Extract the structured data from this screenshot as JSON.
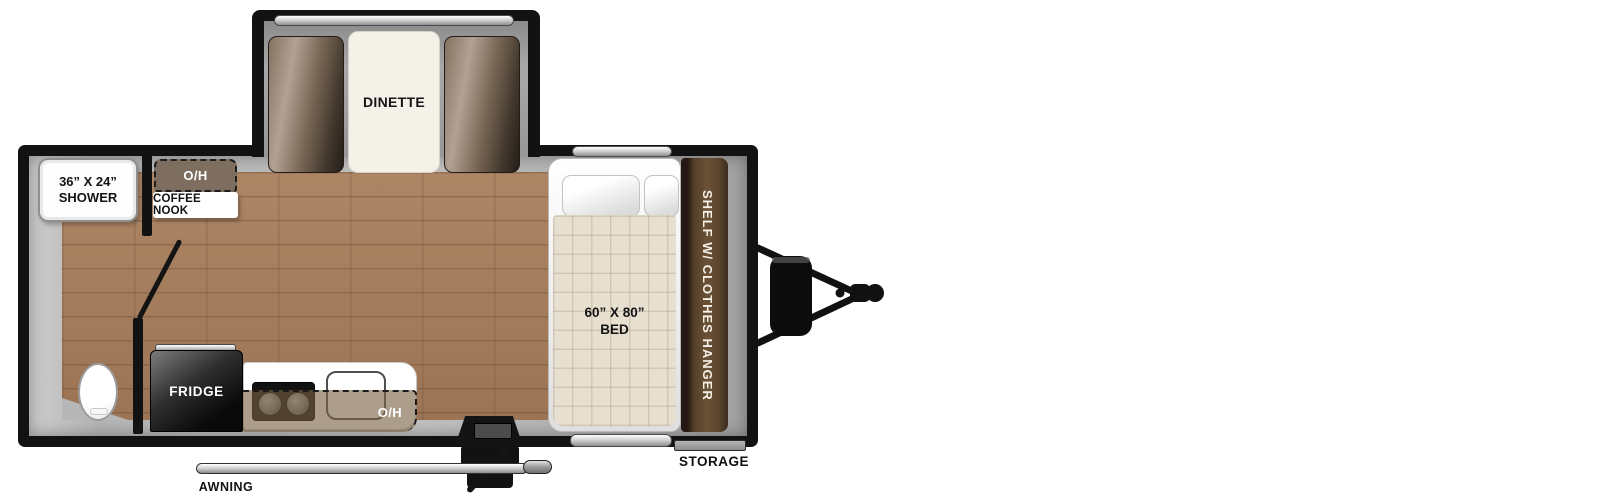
{
  "floorplan": {
    "slideout": {
      "label": "DINETTE"
    },
    "bathroom": {
      "shower": {
        "size": "36” X 24”",
        "label": "SHOWER"
      }
    },
    "coffee_nook": {
      "overhead_label": "O/H",
      "label": "COFFEE NOOK"
    },
    "kitchen": {
      "fridge_label": "FRIDGE",
      "overhead_label": "O/H"
    },
    "bedroom": {
      "bed_size": "60” X 80”",
      "bed_label": "BED",
      "shelf_label": "SHELF W/ CLOTHES HANGER",
      "storage_label": "STORAGE"
    },
    "exterior": {
      "awning_label": "AWNING"
    }
  },
  "colors": {
    "wall": "#121212",
    "interior_band": "#b9b9b9",
    "floor_wood": "#a87e5c",
    "floor_seam": "#5a3c23",
    "slideout_interior": "#979797",
    "bench_brown": "#7a6856",
    "table_cream": "#f4f1e9",
    "shelf_brown": "#6a5136",
    "mattress_beige": "#e7e0d1",
    "counter_white": "#ffffff",
    "overhead_tint": "#7a6246",
    "accent_silver": "#d2d2d2"
  }
}
